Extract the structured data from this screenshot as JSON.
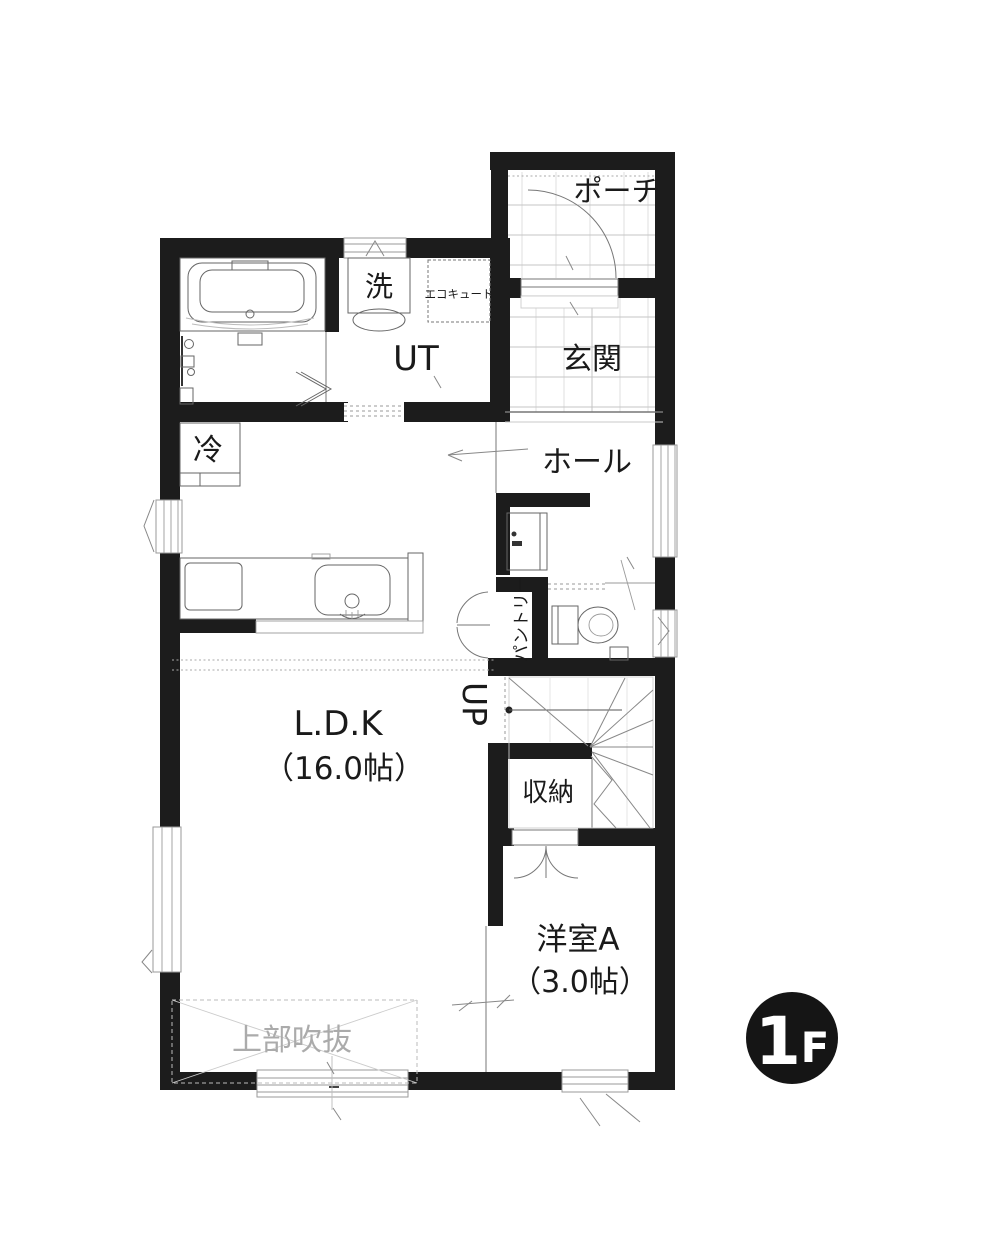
{
  "labels": {
    "porch": "ポーチ",
    "entrance": "玄関",
    "washer": "洗",
    "ecocute": "エコキュート",
    "utility": "UT",
    "hall": "ホール",
    "fridge": "冷",
    "pantry": "パントリー",
    "stairs_up": "UP",
    "ldk_name": "L.D.K",
    "ldk_area": "（16.0帖）",
    "storage": "収納",
    "bedroom_name": "洋室A",
    "bedroom_area": "（3.0帖）",
    "open_above": "上部吹抜"
  },
  "floor_badge": {
    "number": "1",
    "letter": "F"
  },
  "colors": {
    "wall": "#1c1c1c",
    "tile_grid": "#dcdcdc",
    "fixture_line": "#666666",
    "void_text": "#ababab",
    "badge_bg": "#151515",
    "badge_text": "#ffffff"
  }
}
